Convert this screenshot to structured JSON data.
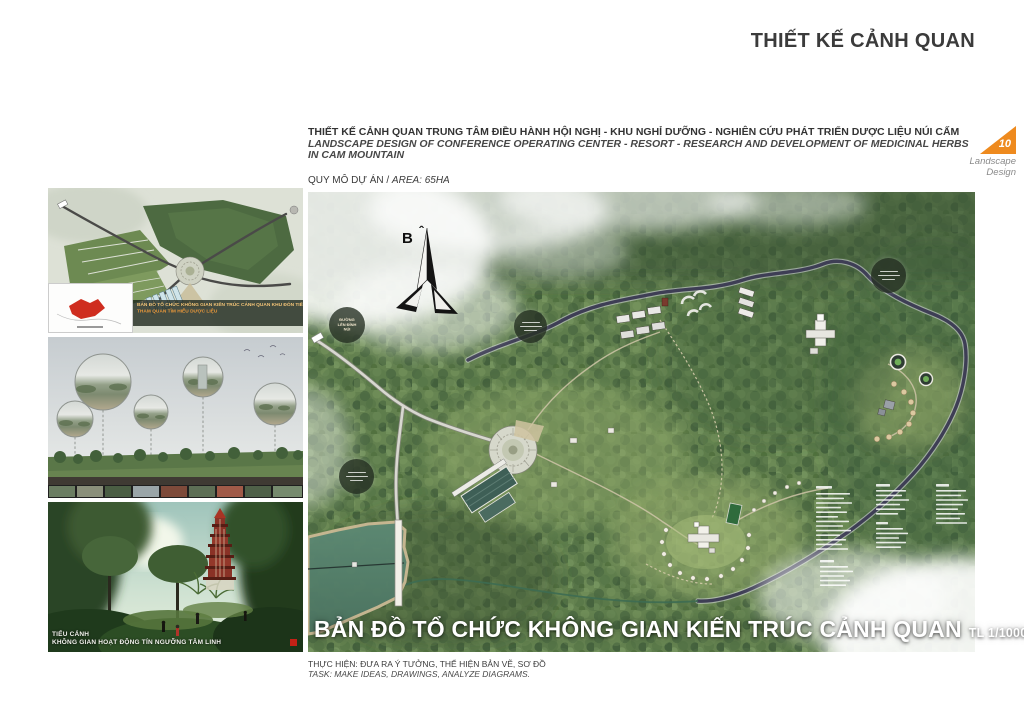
{
  "page_title": "THIẾT KẾ CẢNH QUAN",
  "header": {
    "project_title_vi": "THIẾT KẾ CẢNH QUAN TRUNG TÂM ĐIỀU HÀNH HỘI NGHỊ - KHU NGHỈ DƯỠNG - NGHIÊN CỨU PHÁT TRIỂN DƯỢC LIỆU NÚI CẤM",
    "project_title_en": "LANDSCAPE DESIGN OF CONFERENCE OPERATING CENTER - RESORT - RESEARCH AND DEVELOPMENT OF MEDICINAL HERBS IN CAM MOUNTAIN",
    "area_label_vi": "QUY MÔ DỰ ÁN / ",
    "area_label_en": "AREA: 65HA"
  },
  "page_tab": {
    "number": "10",
    "label_line1": "Landscape",
    "label_line2": "Design",
    "accent_color": "#EE8A1E"
  },
  "sidebar": {
    "figure1_caption_line1": "BẢN ĐỒ TỔ CHỨC KHÔNG GIAN KIẾN TRÚC CẢNH QUAN KHU ĐÓN TIẾP",
    "figure1_caption_line2": "THAM QUAN TÌM HIỂU DƯỢC LIỆU",
    "figure3_caption_line1": "TIỂU CẢNH",
    "figure3_caption_line2": "KHÔNG GIAN HOẠT ĐỘNG TÍN NGƯỠNG TÂM LINH"
  },
  "map": {
    "compass_label": "B",
    "compass_hat": "ˆ",
    "road_label": "ĐƯỜNG LÊN ĐỈNH NÚI",
    "title": "BẢN ĐỒ TỔ CHỨC KHÔNG GIAN KIẾN TRÚC CẢNH QUAN",
    "scale": "TL 1/1000"
  },
  "footer": {
    "task_vi": "THỰC HIỆN: ĐƯA RA Ý TƯỞNG, THỂ HIỆN BẢN VẼ, SƠ ĐỒ",
    "task_en": "TASK: MAKE IDEAS, DRAWINGS, ANALYZE DIAGRAMS."
  }
}
